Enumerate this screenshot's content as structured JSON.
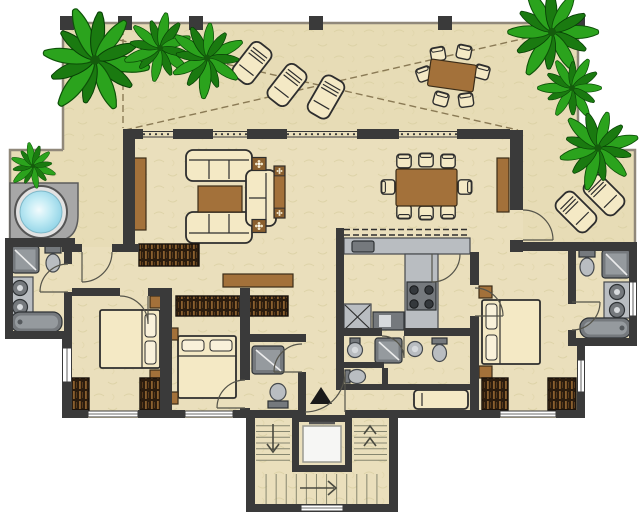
{
  "app": {
    "type": "floor-plan",
    "description": "architectural top-view floor plan of apartment with wrap-around terrace"
  },
  "canvas": {
    "width": 640,
    "height": 516,
    "background": "#ffffff"
  },
  "palette": {
    "wall": "#3a3a3a",
    "floor": "#eadfbc",
    "terrace": "#e7dcb6",
    "fence": "#90887a",
    "wood": "#a3713a",
    "cream": "#f4e9c5",
    "fixture": "#b9bdc1",
    "fixture_dark": "#75797d",
    "palm_light": "#2ba31d",
    "palm_dark": "#1a7a10",
    "platform": "#a7a7a7",
    "roofline": "#8a7a55",
    "water_edge": "#8ed2e6"
  },
  "terrace": {
    "pillars": {
      "y": 16,
      "size": 14,
      "x": [
        67,
        125,
        196,
        316,
        445,
        578
      ]
    },
    "palms": [
      {
        "x": 95,
        "y": 60,
        "s": 1.2,
        "r": 8
      },
      {
        "x": 160,
        "y": 48,
        "s": 0.78,
        "r": 40
      },
      {
        "x": 207,
        "y": 58,
        "s": 0.85,
        "r": -25
      },
      {
        "x": 552,
        "y": 32,
        "s": 1.02,
        "r": 0
      },
      {
        "x": 572,
        "y": 88,
        "s": 0.72,
        "r": 60
      },
      {
        "x": 598,
        "y": 148,
        "s": 0.9,
        "r": -15
      },
      {
        "x": 33,
        "y": 166,
        "s": 0.52,
        "r": 20
      }
    ],
    "sun_loungers": [
      {
        "x": 252,
        "y": 63,
        "r": 38
      },
      {
        "x": 287,
        "y": 85,
        "r": 38
      },
      {
        "x": 326,
        "y": 97,
        "r": 30
      },
      {
        "x": 604,
        "y": 195,
        "r": -45
      },
      {
        "x": 576,
        "y": 212,
        "r": -45
      }
    ],
    "outdoor_dining": {
      "table": {
        "x": 429,
        "y": 62,
        "w": 46,
        "h": 27,
        "rot": 8
      },
      "chairs": [
        {
          "x": 438,
          "y": 54,
          "rot": -10
        },
        {
          "x": 464,
          "y": 52,
          "rot": 12
        },
        {
          "x": 424,
          "y": 74,
          "rot": -20
        },
        {
          "x": 482,
          "y": 72,
          "rot": 15
        },
        {
          "x": 441,
          "y": 99,
          "rot": 15
        },
        {
          "x": 466,
          "y": 100,
          "rot": -8
        }
      ]
    },
    "hot_tub": {
      "cx": 41,
      "cy": 212,
      "r_outer": 26,
      "r_water": 21
    }
  },
  "dining_room": {
    "table": {
      "x": 396,
      "y": 169,
      "w": 61,
      "h": 37,
      "rot": 0
    },
    "chairs": [
      {
        "x": 404,
        "y": 161,
        "rot": 0
      },
      {
        "x": 426,
        "y": 160,
        "rot": 0
      },
      {
        "x": 448,
        "y": 161,
        "rot": 0
      },
      {
        "x": 404,
        "y": 212,
        "rot": 180
      },
      {
        "x": 426,
        "y": 213,
        "rot": 180
      },
      {
        "x": 448,
        "y": 212,
        "rot": 180
      },
      {
        "x": 388,
        "y": 187,
        "rot": 270
      },
      {
        "x": 465,
        "y": 187,
        "rot": 90
      }
    ]
  },
  "living_room": {
    "sofas": 2,
    "loveseat": 1,
    "coffee_table": 1,
    "plant_tables": 4,
    "tv_console": 1
  },
  "kitchen": {
    "appliances": [
      "stove-4-burner",
      "counter-sink",
      "washer",
      "breakfast-bar"
    ]
  },
  "bedrooms": [
    {
      "id": "bedroom-left",
      "bed": "double",
      "wardrobes": 2
    },
    {
      "id": "bedroom-middle",
      "bed": "double",
      "wardrobes": 1
    },
    {
      "id": "bedroom-right",
      "bed": "double",
      "wardrobes": 2
    }
  ],
  "bathrooms": [
    {
      "id": "bathroom-left",
      "fixtures": [
        "shower",
        "toilet",
        "double-sink",
        "bathtub"
      ]
    },
    {
      "id": "bathroom-right",
      "fixtures": [
        "shower",
        "toilet",
        "double-sink",
        "bathtub"
      ]
    },
    {
      "id": "bathroom-center",
      "fixtures": [
        "shower",
        "toilet"
      ]
    },
    {
      "id": "bathroom-kitchen",
      "fixtures": [
        "shower",
        "sink",
        "toilet",
        "wc"
      ]
    }
  ],
  "stairwell": {
    "elevator": true,
    "flights": [
      {
        "x": 256,
        "y": 420,
        "w": 34,
        "h": 46,
        "treads": 7,
        "dir": "h"
      },
      {
        "x": 354,
        "y": 420,
        "w": 33,
        "h": 46,
        "treads": 7,
        "dir": "h"
      },
      {
        "x": 256,
        "y": 474,
        "w": 131,
        "h": 30,
        "treads": 12,
        "dir": "v"
      }
    ]
  }
}
